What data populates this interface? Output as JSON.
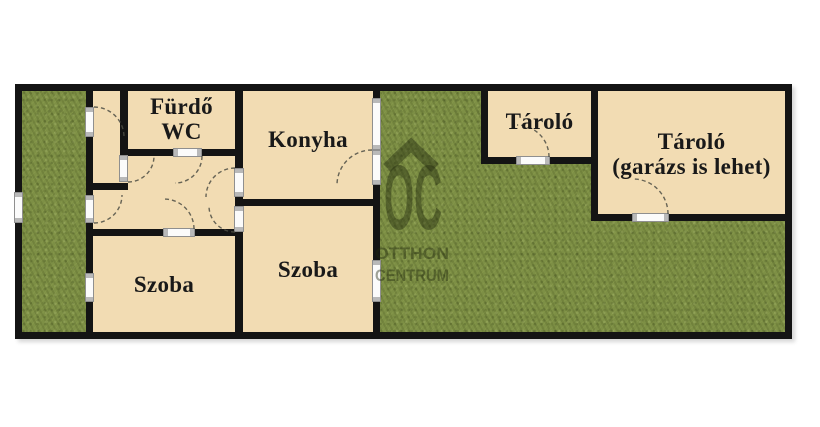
{
  "plan": {
    "rooms": {
      "bathroom": {
        "line1": "Fürdő",
        "line2": "WC"
      },
      "kitchen": {
        "label": "Konyha"
      },
      "room_left": {
        "label": "Szoba"
      },
      "room_middle": {
        "label": "Szoba"
      },
      "storage_small": {
        "label": "Tároló"
      },
      "storage_large": {
        "line1": "Tároló",
        "line2": "(garázs is lehet)"
      }
    },
    "colors": {
      "wall": "#141414",
      "room_fill": "#f2dcb3",
      "grass": "#7d8f45",
      "opening_fill": "#fbfbfb",
      "label_text": "#191919"
    }
  },
  "watermark": {
    "logo": "OC",
    "line1": "OTTHON",
    "line2": "CENTRUM"
  }
}
